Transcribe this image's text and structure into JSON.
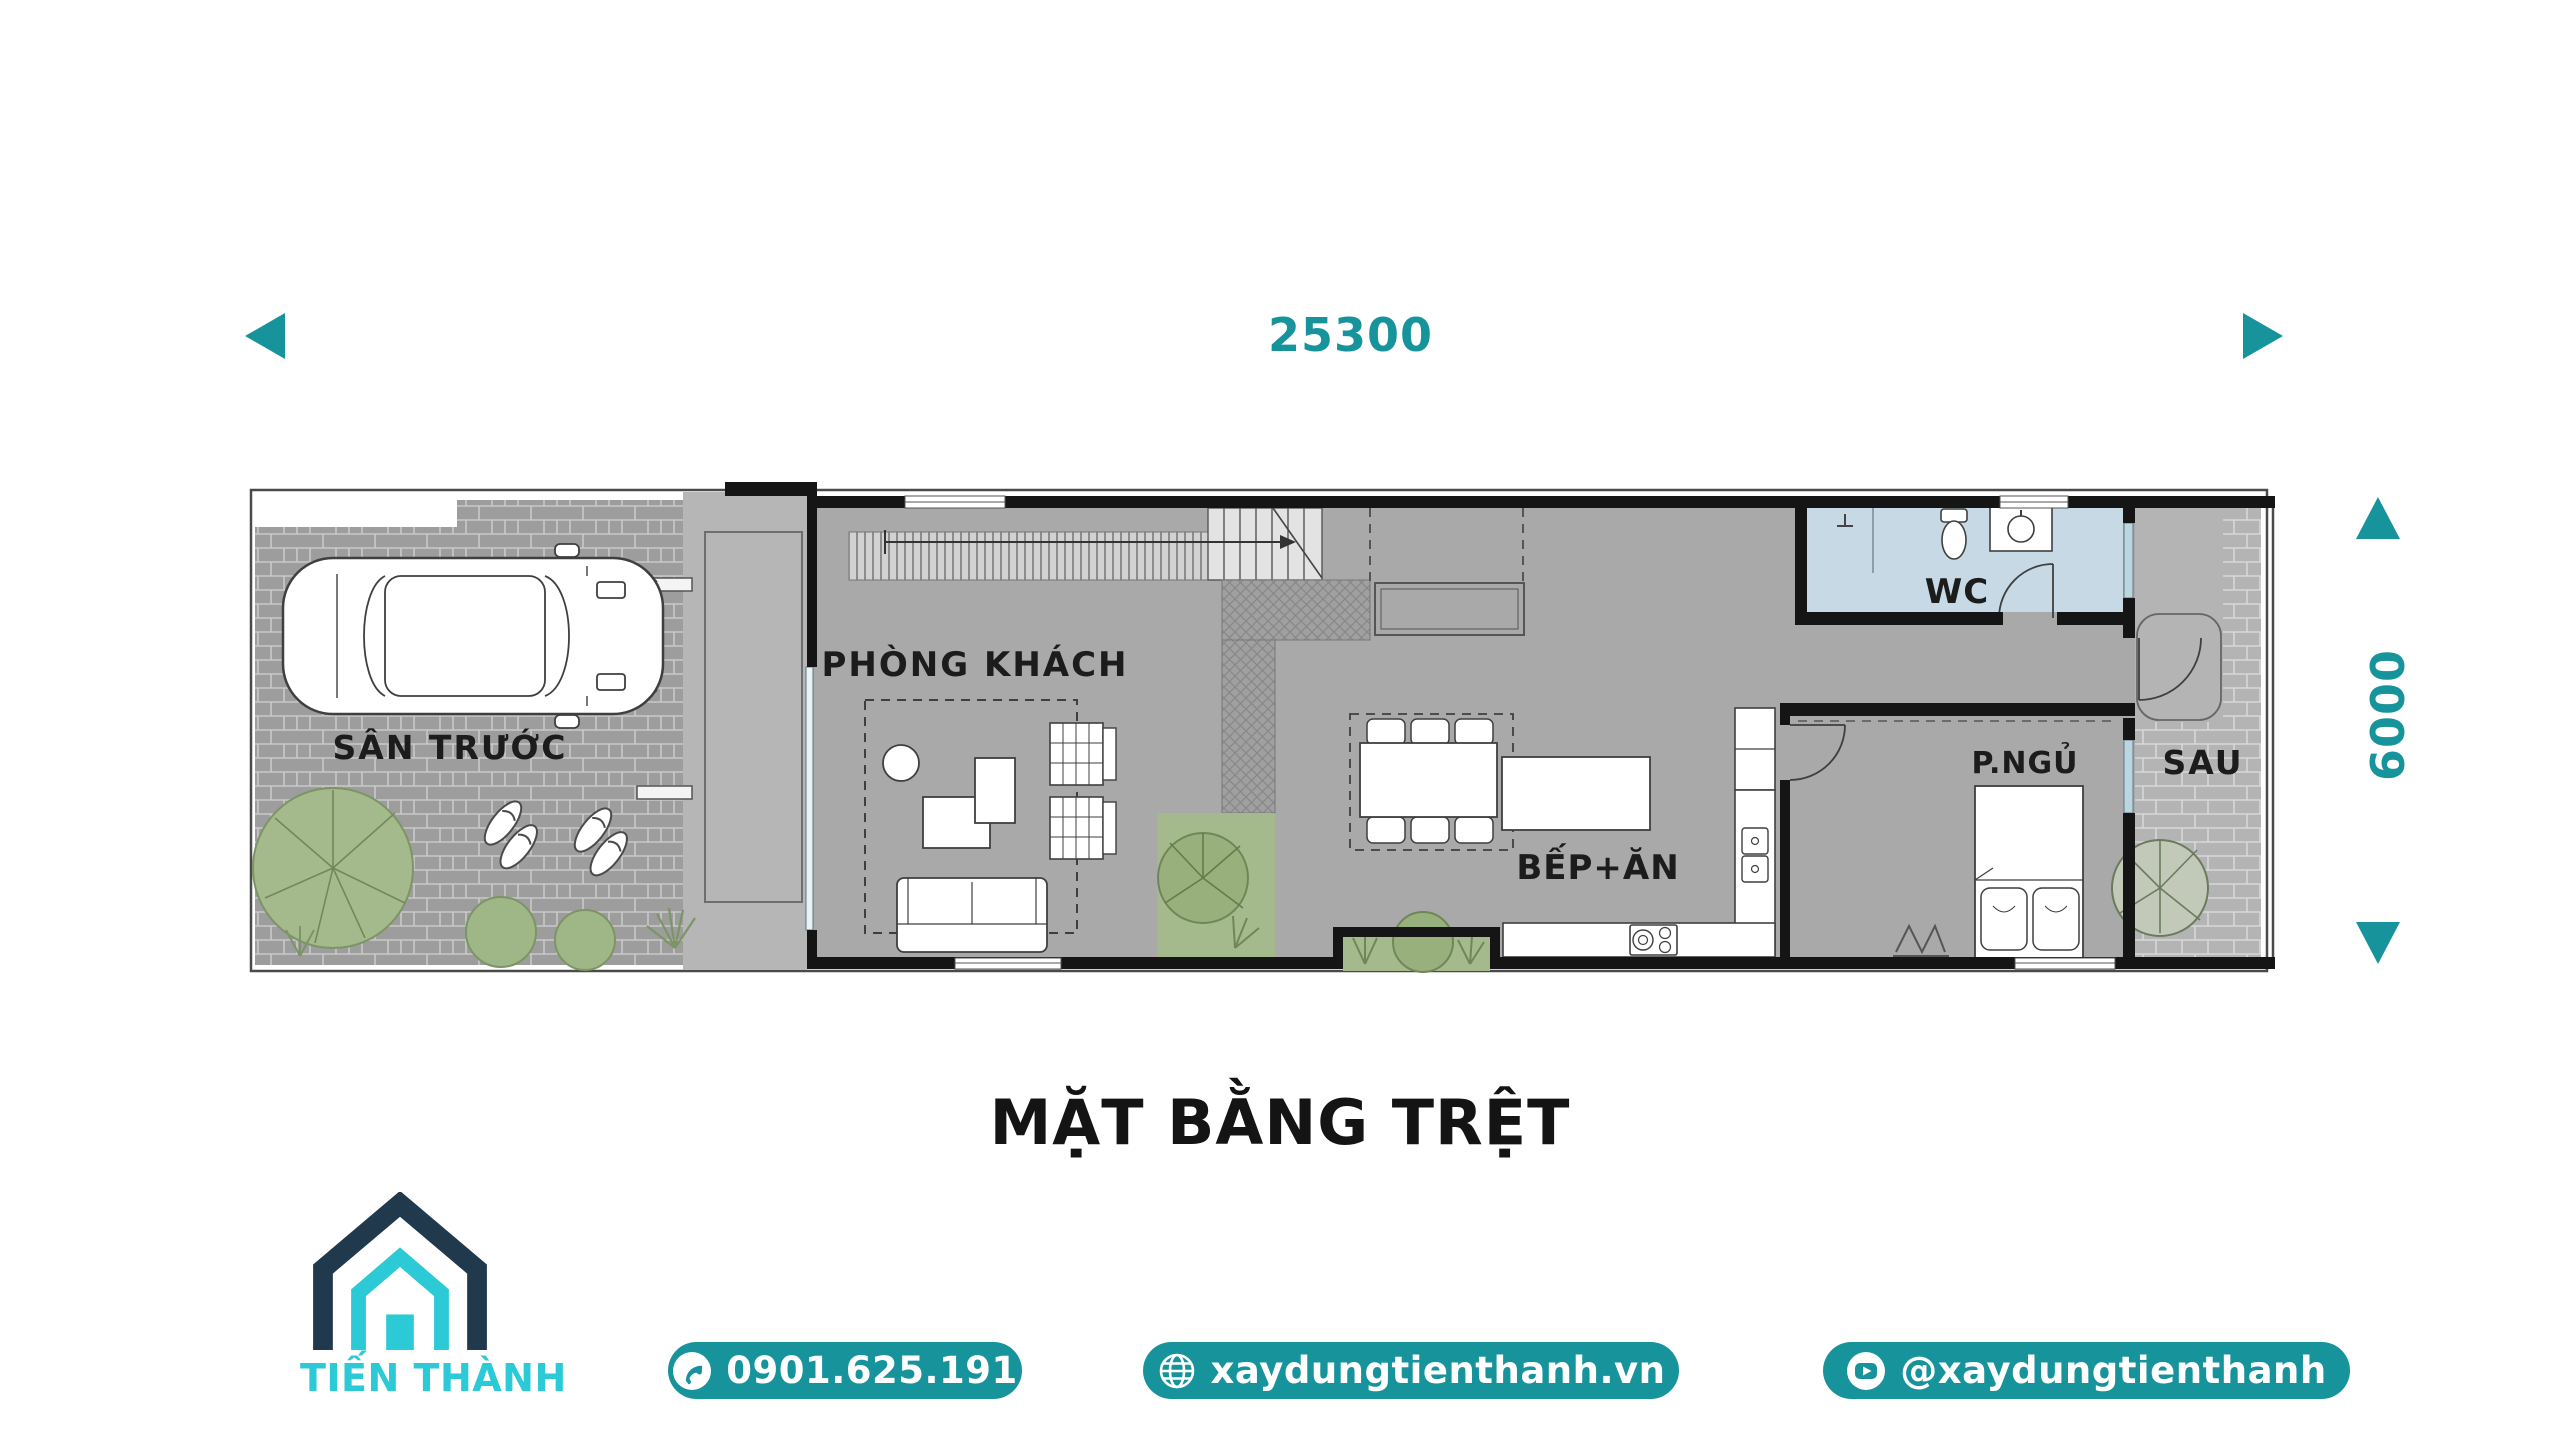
{
  "dimensions": {
    "width": "25300",
    "height": "6000"
  },
  "plan": {
    "rooms": {
      "front_yard": "SÂN TRƯỚC",
      "living_room": "PHÒNG KHÁCH",
      "kitchen_dining": "BẾP+ĂN",
      "wc": "WC",
      "bedroom": "P.NGỦ",
      "back_yard": "SAU"
    }
  },
  "title": "MẶT BẰNG TRỆT",
  "brand": {
    "name": "TIẾN THÀNH"
  },
  "contact": {
    "phone": "0901.625.191",
    "website": "xaydungtienthanh.vn",
    "social": "@xaydungtienthanh"
  },
  "icons": {
    "phone": "phone-icon",
    "website": "globe-icon",
    "social": "youtube-icon",
    "logo": "house-logo-icon",
    "dim_left": "triangle-left-icon",
    "dim_right": "triangle-right-icon",
    "dim_up": "triangle-up-icon",
    "dim_down": "triangle-down-icon"
  },
  "colors": {
    "accent": "#17939C",
    "logo_cyan": "#2BCAD6",
    "logo_navy": "#21394D",
    "wc_floor": "#C6D9E4",
    "plan_gray": "#A9A9A9",
    "greenery": "#A4BA8C",
    "wall": "#151515"
  }
}
